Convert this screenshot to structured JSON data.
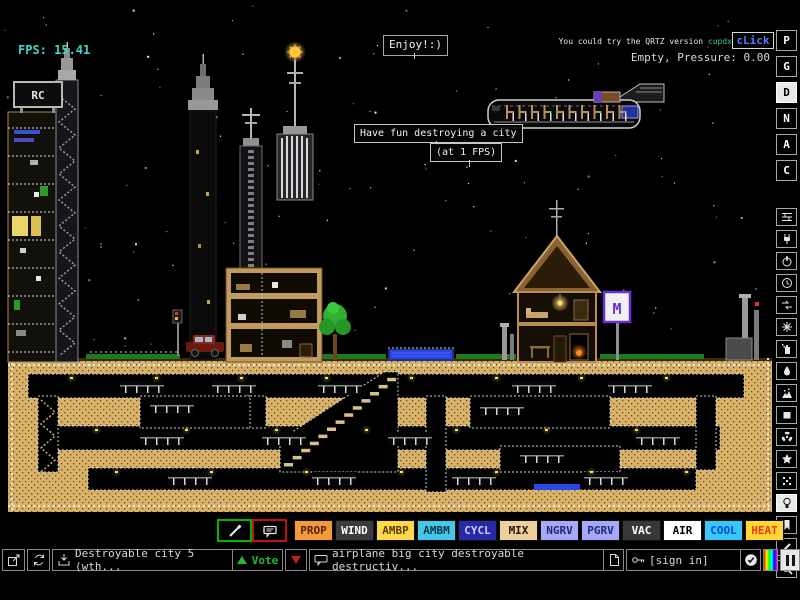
{
  "hud": {
    "fps": "FPS: 15.41",
    "hint_text": "You could try the QRTZ version",
    "hint_user": "cupdx",
    "hint_link": "cLick",
    "status": "Empty, Pressure: 0.00"
  },
  "signs": {
    "enjoy": "Enjoy!:)",
    "have_fun": "Have fun destroying a city",
    "at_fps": "(at 1 FPS)",
    "billboard": "RC",
    "metro": "M"
  },
  "sidebar": {
    "display_modes": [
      {
        "label": "P",
        "active": false
      },
      {
        "label": "G",
        "active": false
      },
      {
        "label": "D",
        "active": true
      },
      {
        "label": "N",
        "active": false
      },
      {
        "label": "A",
        "active": false
      },
      {
        "label": "C",
        "active": false
      }
    ],
    "menus": [
      {
        "name": "walls",
        "active": false
      },
      {
        "name": "electronic",
        "active": false
      },
      {
        "name": "powered",
        "active": false
      },
      {
        "name": "sensors",
        "active": false
      },
      {
        "name": "force",
        "active": false
      },
      {
        "name": "explosive",
        "active": false
      },
      {
        "name": "gases",
        "active": false
      },
      {
        "name": "liquids",
        "active": false
      },
      {
        "name": "powders",
        "active": false
      },
      {
        "name": "solids",
        "active": false
      },
      {
        "name": "radioactive",
        "active": false
      },
      {
        "name": "special",
        "active": false
      },
      {
        "name": "life",
        "active": false
      },
      {
        "name": "tools",
        "active": true
      },
      {
        "name": "favorites",
        "active": false
      },
      {
        "name": "decoration",
        "active": false
      },
      {
        "name": "search",
        "active": false
      }
    ],
    "pause_active": true
  },
  "element_bar": {
    "selected_left_tool": "sample",
    "selected_right_tool": "sign",
    "elements": [
      {
        "label": "PROP",
        "bg": "#f09a3c",
        "fg": "#5a1e00"
      },
      {
        "label": "WIND",
        "bg": "#3c3c3c",
        "fg": "#ffffff"
      },
      {
        "label": "AMBP",
        "bg": "#ffd84a",
        "fg": "#5a3c00"
      },
      {
        "label": "AMBM",
        "bg": "#44c8e8",
        "fg": "#00344a"
      },
      {
        "label": "CYCL",
        "bg": "#2828a8",
        "fg": "#d0d0ff"
      },
      {
        "label": "MIX",
        "bg": "#ecd0a0",
        "fg": "#281400"
      },
      {
        "label": "NGRV",
        "bg": "#a8a8f8",
        "fg": "#182878"
      },
      {
        "label": "PGRV",
        "bg": "#a8a8f8",
        "fg": "#182878"
      },
      {
        "label": "VAC",
        "bg": "#383838",
        "fg": "#ffffff"
      },
      {
        "label": "AIR",
        "bg": "#ffffff",
        "fg": "#000000"
      },
      {
        "label": "COOL",
        "bg": "#38c8f8",
        "fg": "#0048e0"
      },
      {
        "label": "HEAT",
        "bg": "#ffd838",
        "fg": "#f03800"
      }
    ]
  },
  "toolbar": {
    "save_title": "Destroyable city 5 (wth...",
    "vote_up_label": "Vote",
    "tags": "airplane big city destroyable destructiv...",
    "sign_in": "[sign in]"
  },
  "colors": {
    "fps_teal": "#3fd8c8",
    "link_blue": "#5878ff",
    "hint_user_green": "#3cc88c",
    "vote_green": "#2fb42f",
    "vote_red": "#c02020"
  }
}
